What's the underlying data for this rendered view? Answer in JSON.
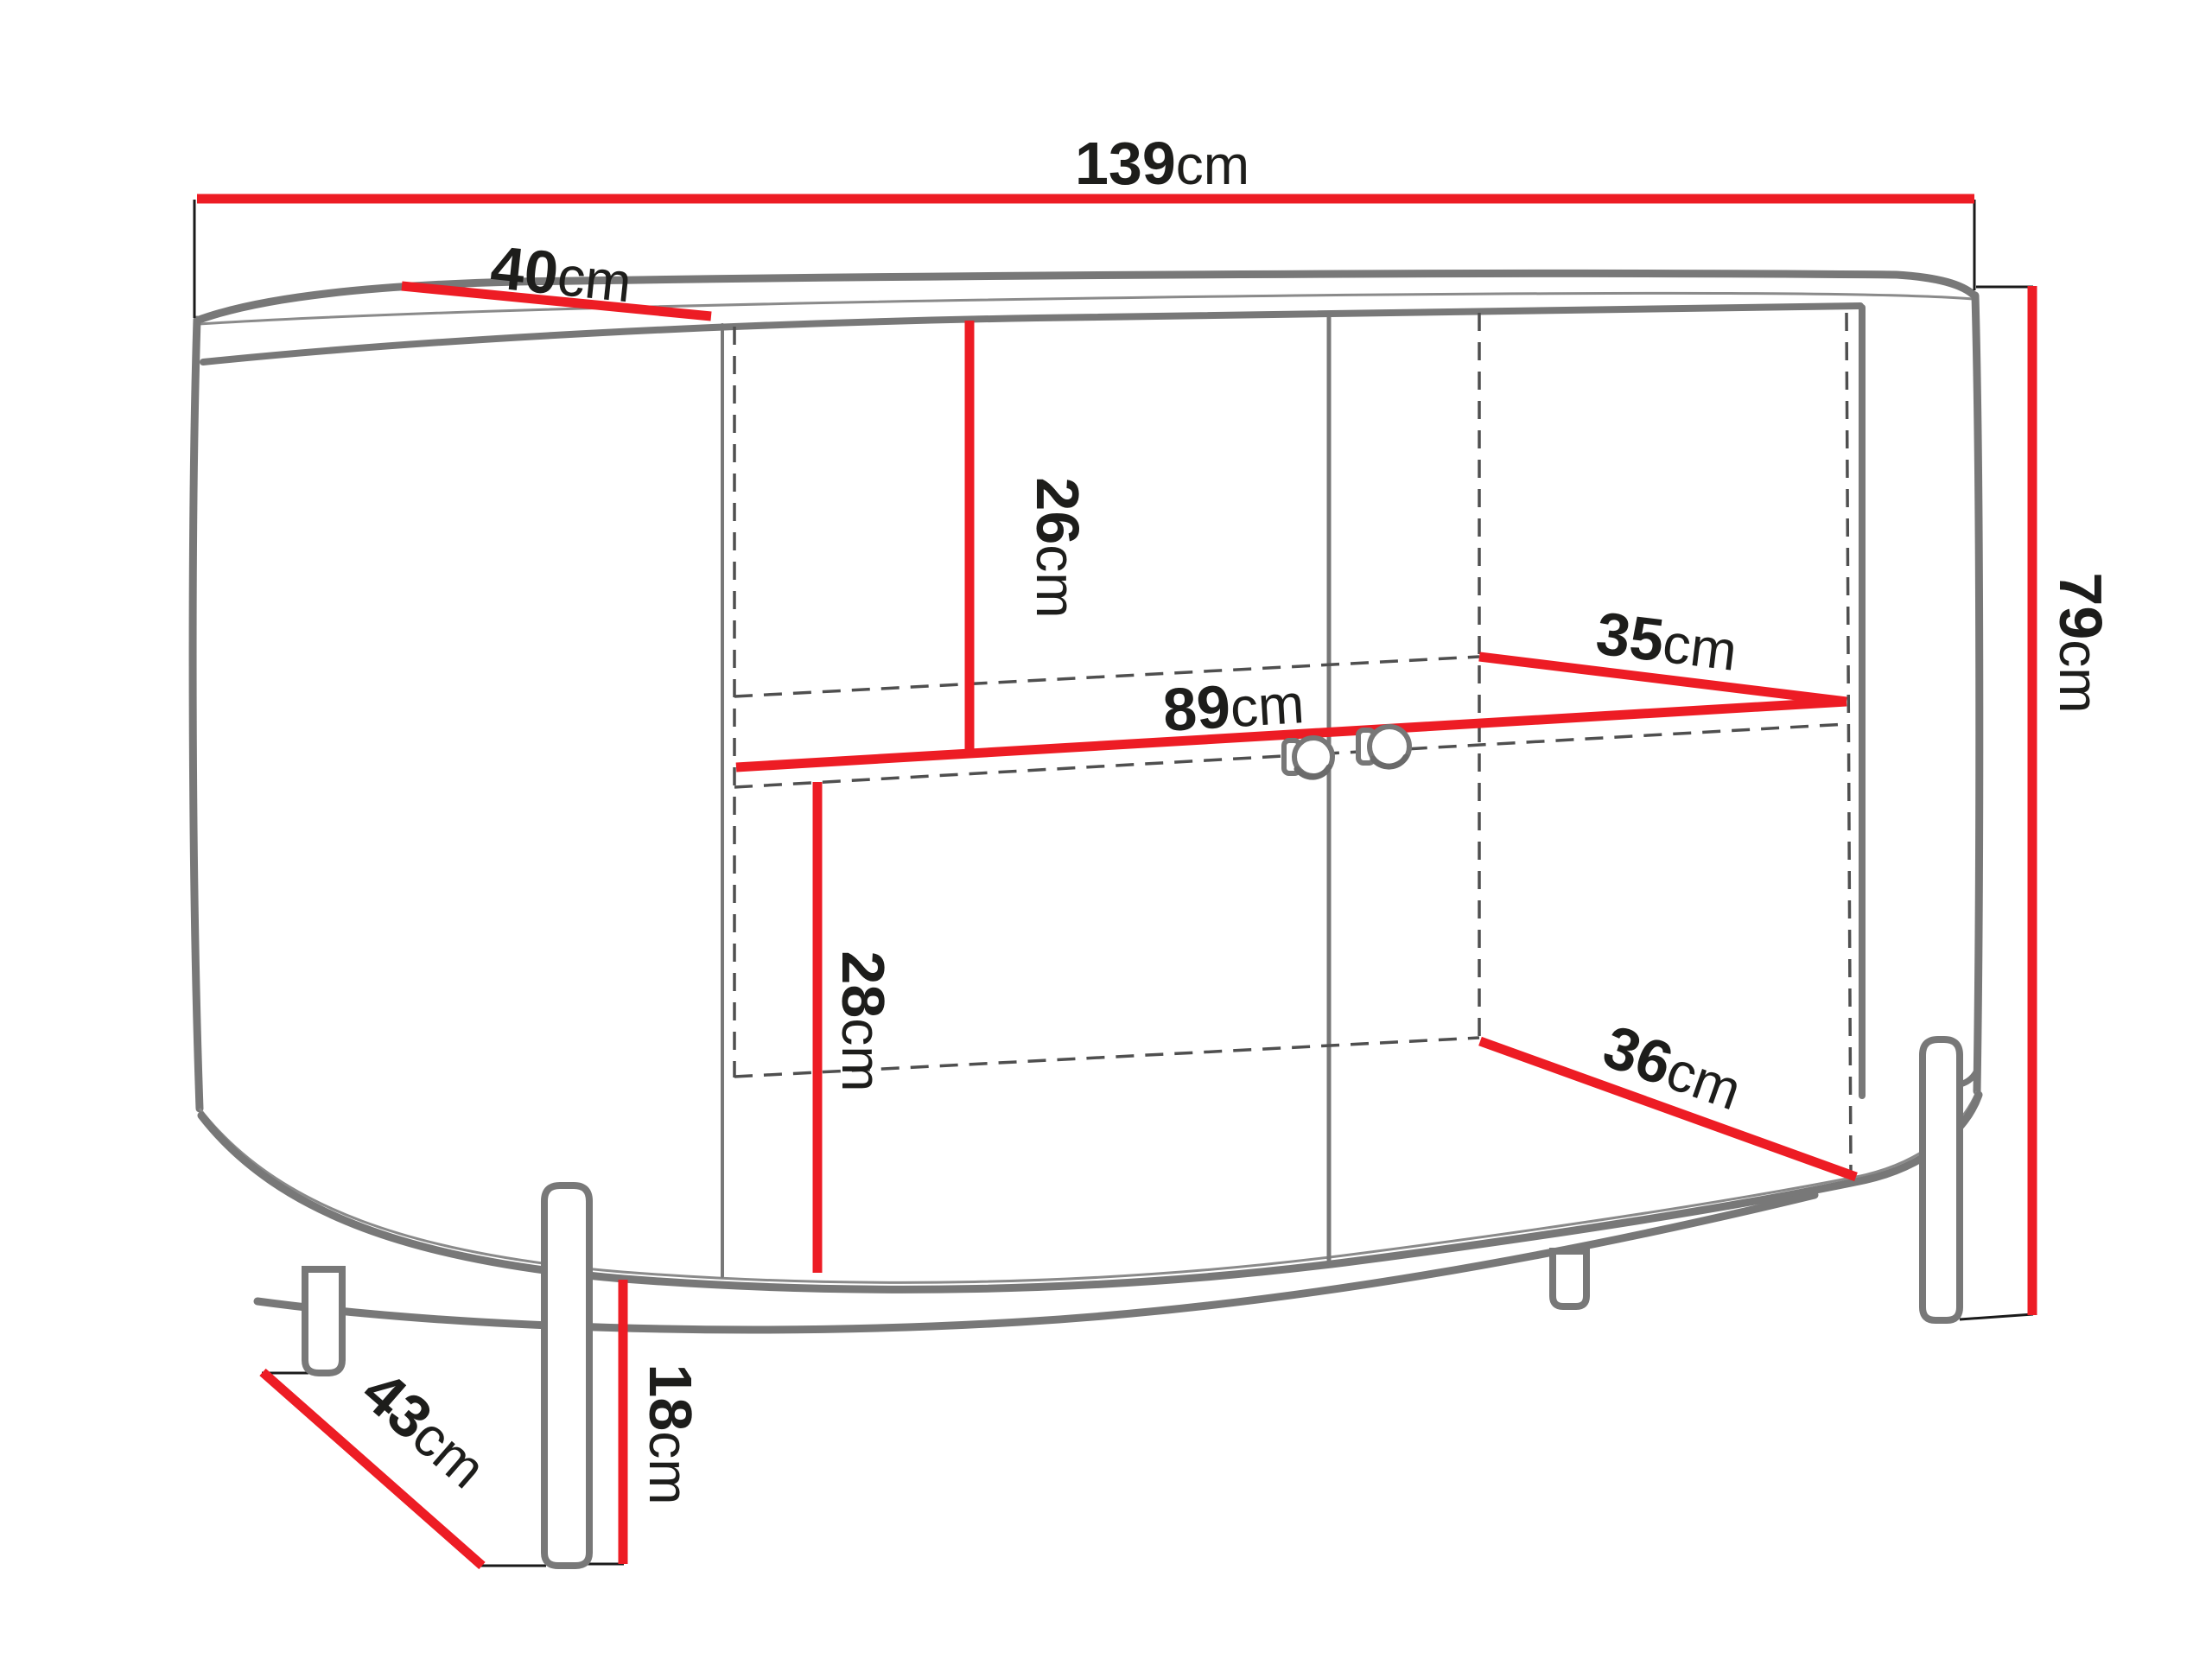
{
  "diagram": {
    "type": "furniture-dimension-drawing",
    "background": "#ffffff",
    "colors": {
      "dimension_line": "#ed1c24",
      "outline": "#787878",
      "hidden_line": "#4f4f4f",
      "extension_line": "#1a1a1a",
      "label_text": "#1d1d1b"
    },
    "dimensions": {
      "overall_width": {
        "value": "139",
        "unit": "cm"
      },
      "top_depth": {
        "value": "40",
        "unit": "cm"
      },
      "upper_compartment_height": {
        "value": "26",
        "unit": "cm"
      },
      "shelf_width": {
        "value": "89",
        "unit": "cm"
      },
      "shelf_depth": {
        "value": "35",
        "unit": "cm"
      },
      "lower_compartment_height": {
        "value": "28",
        "unit": "cm"
      },
      "bottom_shelf_depth": {
        "value": "36",
        "unit": "cm"
      },
      "overall_height": {
        "value": "79",
        "unit": "cm"
      },
      "legs_diagonal_spacing": {
        "value": "43",
        "unit": "cm"
      },
      "leg_height": {
        "value": "18",
        "unit": "cm"
      }
    }
  }
}
